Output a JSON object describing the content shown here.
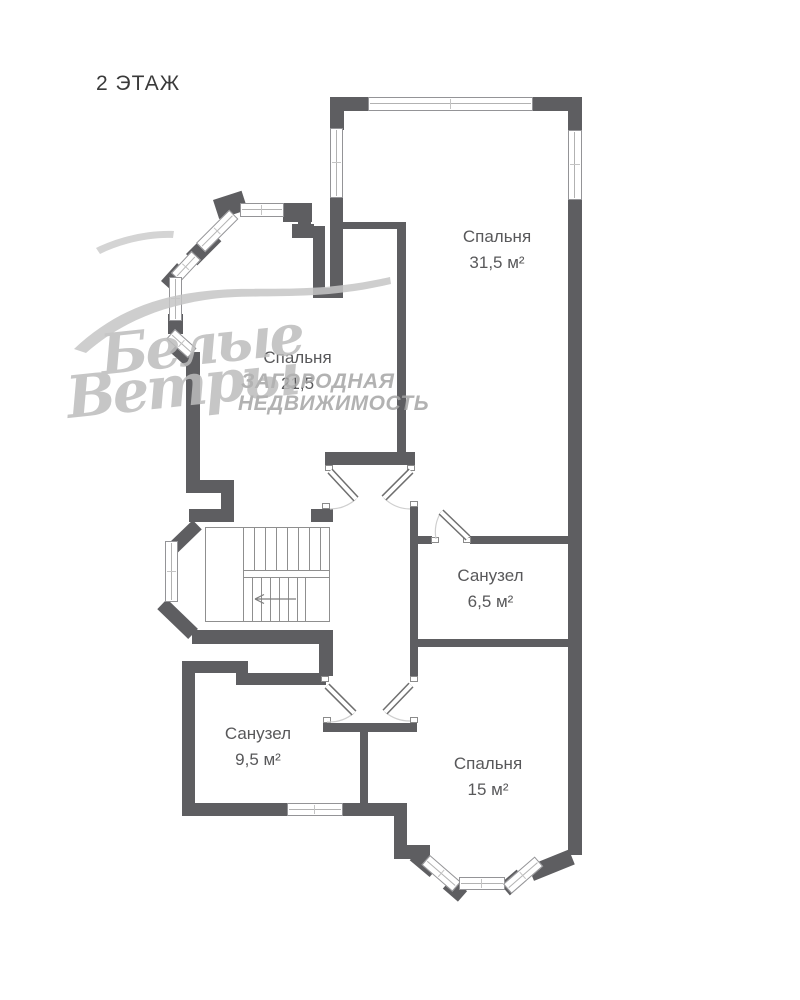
{
  "title": "2 ЭТАЖ",
  "rooms": [
    {
      "name": "Спальня",
      "area": "31,5 м²"
    },
    {
      "name": "Спальня",
      "area": "21,5"
    },
    {
      "name": "Санузел",
      "area": "6,5 м²"
    },
    {
      "name": "Санузел",
      "area": "9,5 м²"
    },
    {
      "name": "Спальня",
      "area": "15 м²"
    }
  ],
  "watermark": {
    "script_line1": "Белые",
    "script_line2": "Ветры",
    "caps_line1": "ЗАГОРОДНАЯ",
    "caps_line2": "НЕДВИЖИМОСТЬ"
  },
  "colors": {
    "wall": "#5e5e61",
    "label_text": "#58585a",
    "title_text": "#3a3a3a",
    "watermark_script": "#bdbdbd",
    "watermark_caps": "#a5a5a5",
    "thin_lines": "#8f8f8f"
  }
}
